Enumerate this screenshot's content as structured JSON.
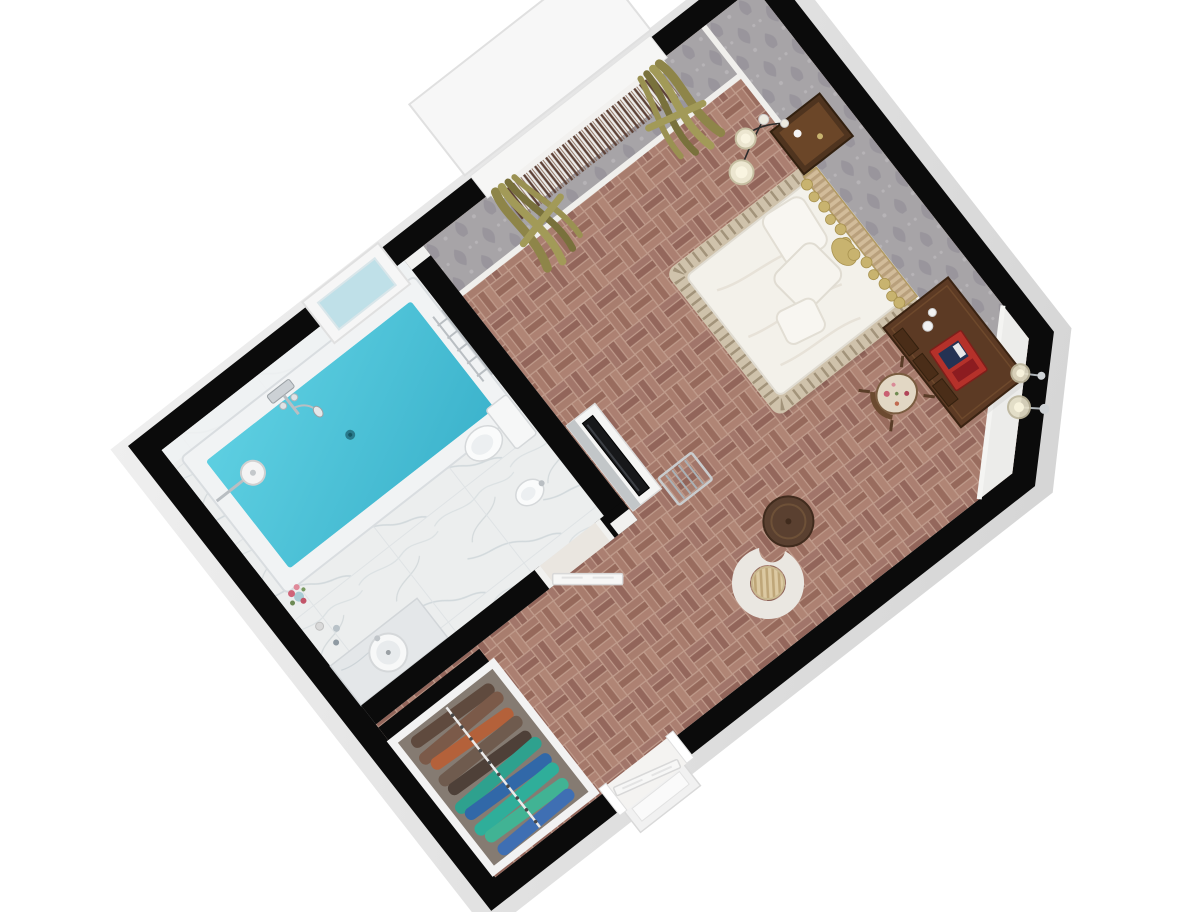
{
  "scene": {
    "kind": "3d-rendered-floor-plan",
    "view": "top-down-rotated",
    "rooms": [
      "bedroom",
      "bathroom",
      "entry-hall",
      "closet-nook"
    ]
  },
  "colors": {
    "background": "#ffffff",
    "wall": "#0b0b0b",
    "wall_outer_face": "#e3e3e3",
    "parquet_base": "#a3786a",
    "marble_floor": "#eceeee",
    "wallpaper": "#a7a4a7",
    "baseboard": "#f0efec",
    "water": "#4cc3da",
    "tub_rim": "#f1f3f4",
    "bed_linen": "#f3f1ea",
    "bed_skirt": "#cfc2ab",
    "headboard_gold": "#c8b36f",
    "headboard_fabric": "#d2bc9a",
    "dark_wood": "#5c3a24",
    "nightstand_wood": "#4f341f",
    "table_wood": "#5a4030",
    "armchair": "#eae7e1",
    "cushion": "#dcc9a2",
    "tv_black": "#17181a",
    "curtain_olive": "#a29a58",
    "curtain_olive_dark": "#79713c",
    "string_curtain": "#5d4136",
    "closet_floor": "#857b72",
    "door_white": "#f7f7f6",
    "chrome": "#c9ced2",
    "minibar_tray_red": "#b5312a",
    "flower_pink": "#cf6478"
  },
  "bedroom": {
    "furniture": [
      "double-bed",
      "pillows",
      "ornate-gold-headboard",
      "bed-skirt",
      "nightstand",
      "pendant-lamp-pair",
      "writing-desk",
      "minibar-tray",
      "floral-chair",
      "glass-floor-lamp-pair",
      "armchair",
      "round-coffee-table",
      "tv",
      "tv-cabinet",
      "luggage-rack",
      "window",
      "olive-drapes",
      "string-curtain"
    ]
  },
  "bathroom": {
    "fixtures": [
      "soaking-tub",
      "tub-faucet",
      "hand-shower",
      "overhead-shower",
      "wall-niche-window",
      "towel-ladder",
      "toilet",
      "bidet",
      "vanity-sink",
      "toiletries",
      "flower-vase",
      "bathroom-door"
    ]
  },
  "entry": {
    "items": [
      "entry-door",
      "door-threshold",
      "open-closet",
      "clothes-rail",
      "hanging-clothes"
    ]
  },
  "closet_clothes_colors": [
    "#5f4a3e",
    "#7b5a49",
    "#b4613a",
    "#6f5b4e",
    "#4e4038",
    "#2ea18e",
    "#3168a8",
    "#2fae9a",
    "#41b394",
    "#3f6fb3"
  ]
}
